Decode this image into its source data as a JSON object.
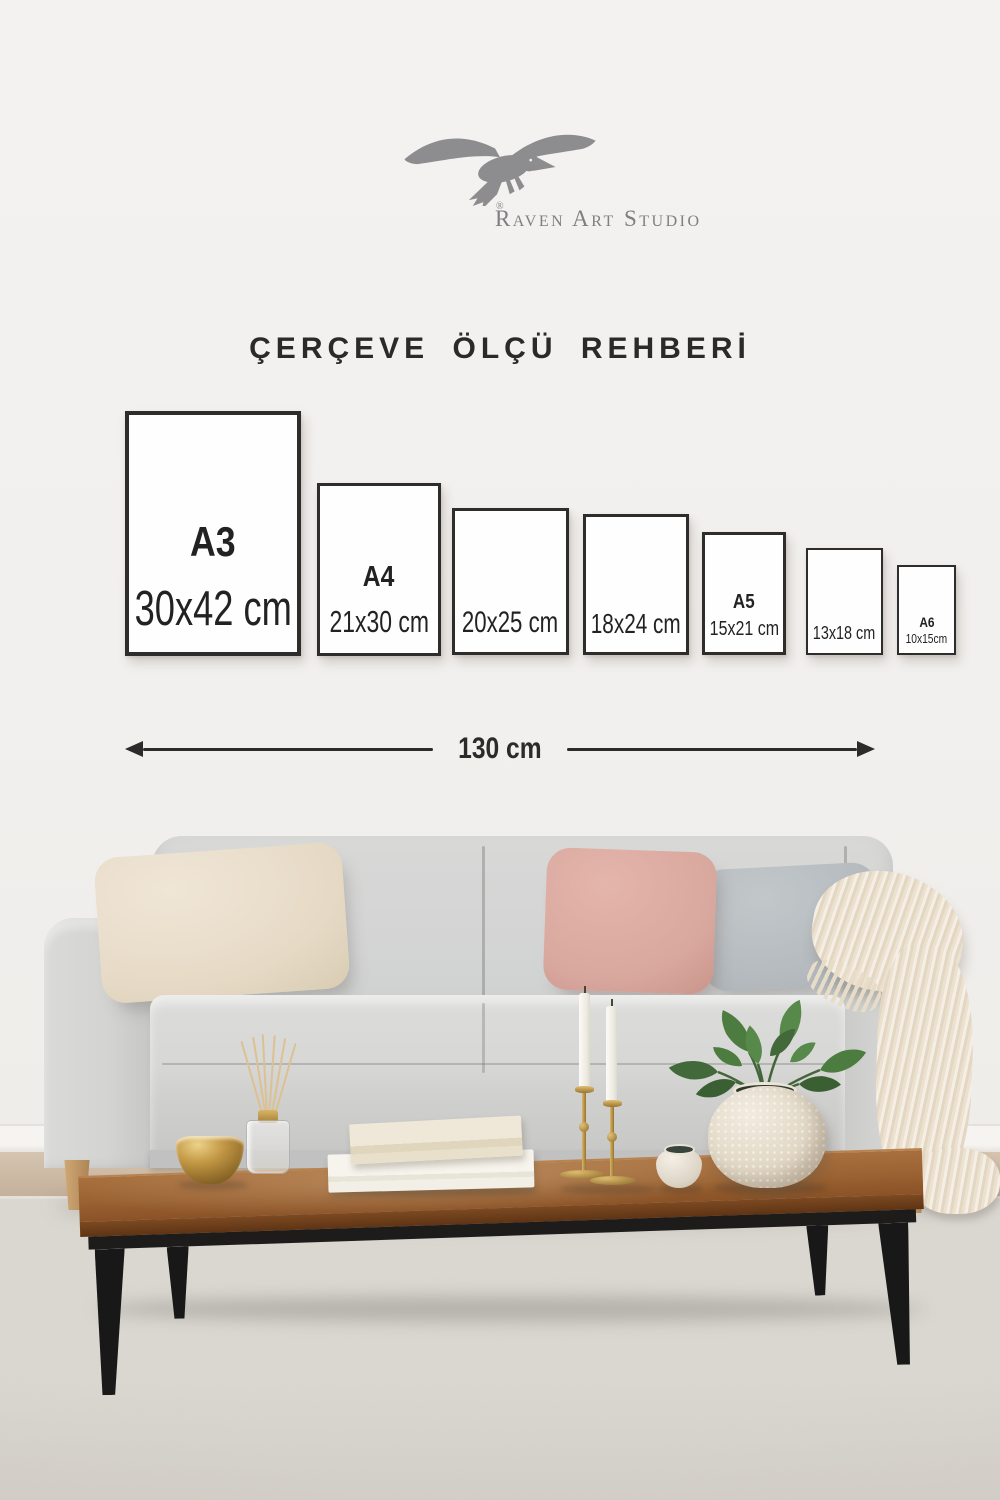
{
  "brand": {
    "logo_text": "Raven Art Studio",
    "registered_mark": "®",
    "logo_color": "#7e7f82"
  },
  "title": {
    "text": "ÇERÇEVE ÖLÇÜ REHBERİ",
    "color": "#2b2a28"
  },
  "size_guide": {
    "frames": [
      {
        "label": "A3",
        "size": "30x42 cm"
      },
      {
        "label": "A4",
        "size": "21x30 cm"
      },
      {
        "label": "",
        "size": "20x25 cm"
      },
      {
        "label": "",
        "size": "18x24 cm"
      },
      {
        "label": "A5",
        "size": "15x21 cm"
      },
      {
        "label": "",
        "size": "13x18 cm"
      },
      {
        "label": "A6",
        "size": "10x15cm"
      }
    ],
    "frame_fill": "#fefefe",
    "frame_border_color": "#2e2d2b"
  },
  "ruler": {
    "label": "130 cm",
    "color": "#2b2b2b"
  },
  "scene": {
    "sofa_color": "#d3d4d4",
    "pillow_colors": [
      "#e8ddcb",
      "#d9a79d",
      "#b6bcc0"
    ],
    "throw_color": "#ece1cf",
    "table_wood_color": "#9a6232",
    "rug_color": "#dbd8d2",
    "wall_color": "#f2f0ee"
  }
}
